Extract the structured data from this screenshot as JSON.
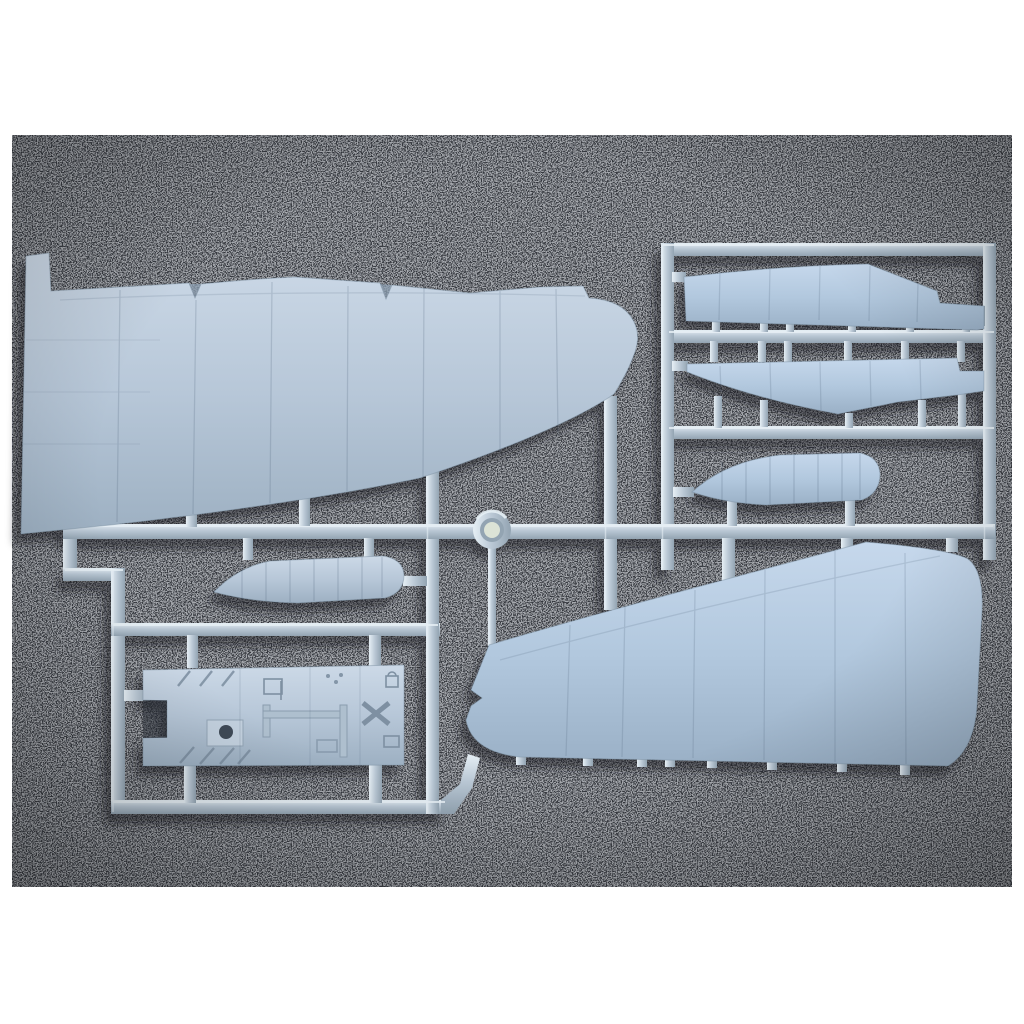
{
  "scene": {
    "type": "photograph",
    "description": "Photograph of a light blue-grey injection-moulded plastic model aircraft sprue (wing halves, tailplane halves, two long narrow strips and a cockpit floor panel joined by runner frames and a circular moulding ring) lying on a dark grey speckled mat, with a white photo border",
    "surface": "dark grey speckled foam mat",
    "border": "white photo margin on all sides"
  },
  "photo": {
    "x": 12,
    "y": 135,
    "width": 1000,
    "height": 752
  },
  "colors": {
    "white": "#ffffff",
    "mat": "#35383e",
    "speckle": "#cfd4da",
    "plastic_light": "#ccd9e7",
    "plastic_mid": "#b7c7d8",
    "plastic_dark": "#9db0c2",
    "plastic_blue_light": "#c6d8ec",
    "plastic_blue_mid": "#b2c8de",
    "plastic_blue_dark": "#9ab0c6",
    "runner_light": "#e6eff5",
    "runner_mid": "#b9c7d4",
    "runner_dark": "#93a4b2",
    "hole": "#dce3d6",
    "shadow": "#14171c",
    "panel_line": "#51657c"
  },
  "parts": [
    {
      "id": "wing-upper-left",
      "label": "large wing half, upper surface",
      "position": "top-left"
    },
    {
      "id": "narrow-strip-upper",
      "label": "long narrow part",
      "position": "top-right upper"
    },
    {
      "id": "narrow-strip-lower",
      "label": "long narrow part",
      "position": "top-right lower"
    },
    {
      "id": "tailplane-right",
      "label": "small tailplane half",
      "position": "right centre"
    },
    {
      "id": "tailplane-left",
      "label": "small tailplane half",
      "position": "left centre"
    },
    {
      "id": "wing-lower-right",
      "label": "large wing half, lower surface",
      "position": "bottom-right"
    },
    {
      "id": "cockpit-floor",
      "label": "cockpit floor interior panel",
      "position": "bottom-left"
    }
  ],
  "sprue": {
    "material": "light blue-grey styrene",
    "ring": "circular moulding ring at centre of main runner",
    "runners": "horizontal main runner with rectangular frame sections and vertical cross-runners"
  }
}
